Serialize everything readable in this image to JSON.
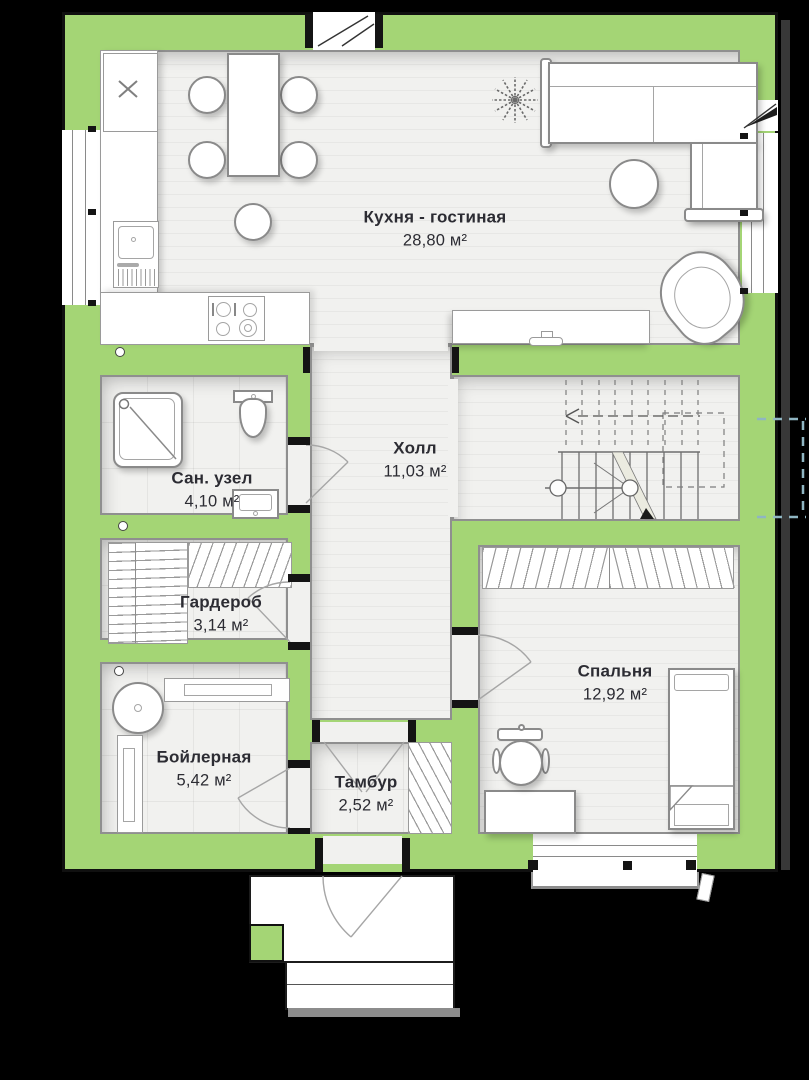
{
  "rooms": {
    "kitchen_living": {
      "name": "Кухня - гостиная",
      "area": "28,80 м²"
    },
    "hall": {
      "name": "Холл",
      "area": "11,03 м²"
    },
    "bathroom": {
      "name": "Сан. узел",
      "area": "4,10 м²"
    },
    "wardrobe": {
      "name": "Гардероб",
      "area": "3,14 м²"
    },
    "boiler": {
      "name": "Бойлерная",
      "area": "5,42 м²"
    },
    "vestibule": {
      "name": "Тамбур",
      "area": "2,52 м²"
    },
    "bedroom": {
      "name": "Спальня",
      "area": "12,92 м²"
    }
  },
  "colors": {
    "wall_green": "#a4d575",
    "floor": "#f1f1ef",
    "outline": "#101010",
    "background": "#000000",
    "furniture_stroke": "#8a8a8a",
    "terrace_dash": "#8fb5c2",
    "label_text": "#2c2c33"
  },
  "furniture_icons": [
    "dining-table",
    "dining-chair",
    "stool",
    "kitchen-counter",
    "kitchen-sink",
    "hob",
    "fridge-unit",
    "corner-sofa",
    "coffee-table",
    "armchair",
    "plant",
    "island-counter",
    "shower",
    "toilet",
    "washbasin",
    "wardrobe-shelving",
    "boiler",
    "radiator",
    "staircase",
    "bed",
    "desk",
    "office-chair",
    "entrance-porch",
    "window",
    "door-arc"
  ]
}
